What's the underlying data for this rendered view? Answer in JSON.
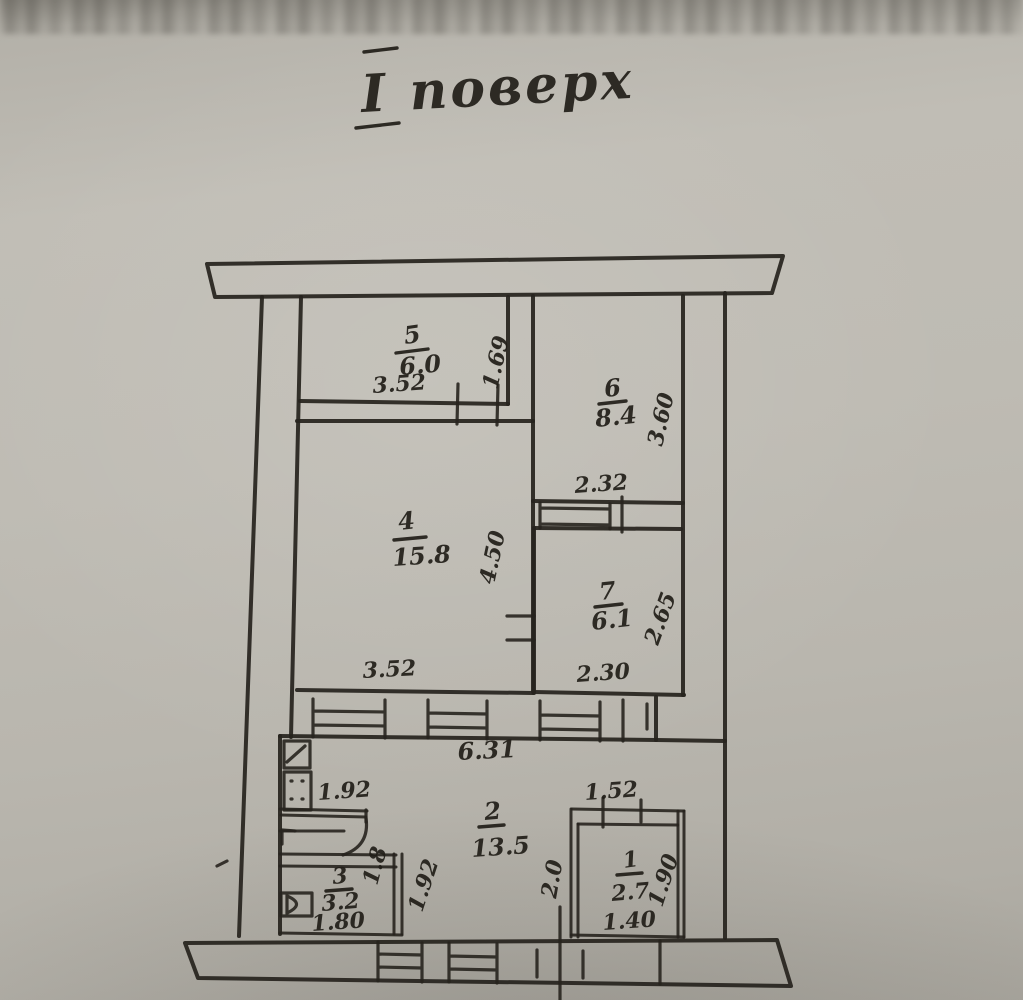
{
  "title": {
    "floor_label": "І поверх"
  },
  "plan": {
    "rooms": {
      "room5": {
        "number": "5",
        "area": "6.0",
        "width": "3.52",
        "depth": "1.69"
      },
      "room6": {
        "number": "6",
        "area": "8.4",
        "width": "2.32",
        "depth": "3.60"
      },
      "room4": {
        "number": "4",
        "area": "15.8",
        "width": "3.52",
        "depth": "4.50"
      },
      "room7": {
        "number": "7",
        "area": "6.1",
        "width": "2.30",
        "depth": "2.65"
      },
      "room2": {
        "number": "2",
        "area": "13.5",
        "length": "6.31",
        "niche_width": "1.92",
        "right_width": "1.52",
        "left_depth": "1.92",
        "entry_depth": "2.0"
      },
      "room3": {
        "number": "3",
        "area": "3.2",
        "width": "1.80",
        "depth": "1.8"
      },
      "room1": {
        "number": "1",
        "area": "2.7",
        "width": "1.40",
        "depth": "1.90"
      }
    }
  },
  "colors": {
    "paper": "#bcb9b1",
    "ink": "#27241e"
  }
}
